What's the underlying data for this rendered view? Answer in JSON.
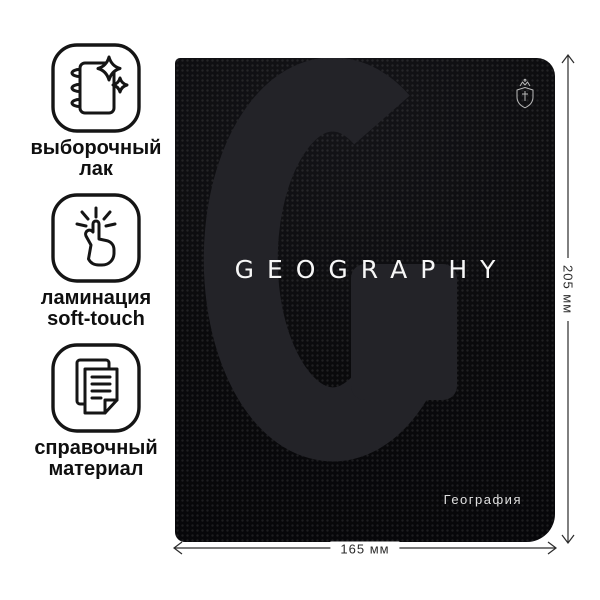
{
  "page": {
    "background": "#ffffff"
  },
  "features": [
    {
      "icon": "notebook-varnish-icon",
      "label_lines": [
        "выборочный",
        "лак"
      ]
    },
    {
      "icon": "soft-touch-tap-icon",
      "label_lines": [
        "ламинация",
        "soft-touch"
      ]
    },
    {
      "icon": "reference-sheets-icon",
      "label_lines": [
        "справочный",
        "материал"
      ]
    }
  ],
  "cover": {
    "title": "GEOGRAPHY",
    "subject_label": "География",
    "watermark_letter": "G",
    "brand_emblem": "crown-shield-emblem",
    "colors": {
      "cover_bg": "#0a0a0c",
      "watermark": "#232328",
      "title_text": "#f7f7f7",
      "subject_text": "#e0e0e0"
    }
  },
  "dimensions": {
    "width_label": "165 мм",
    "height_label": "205 мм"
  }
}
